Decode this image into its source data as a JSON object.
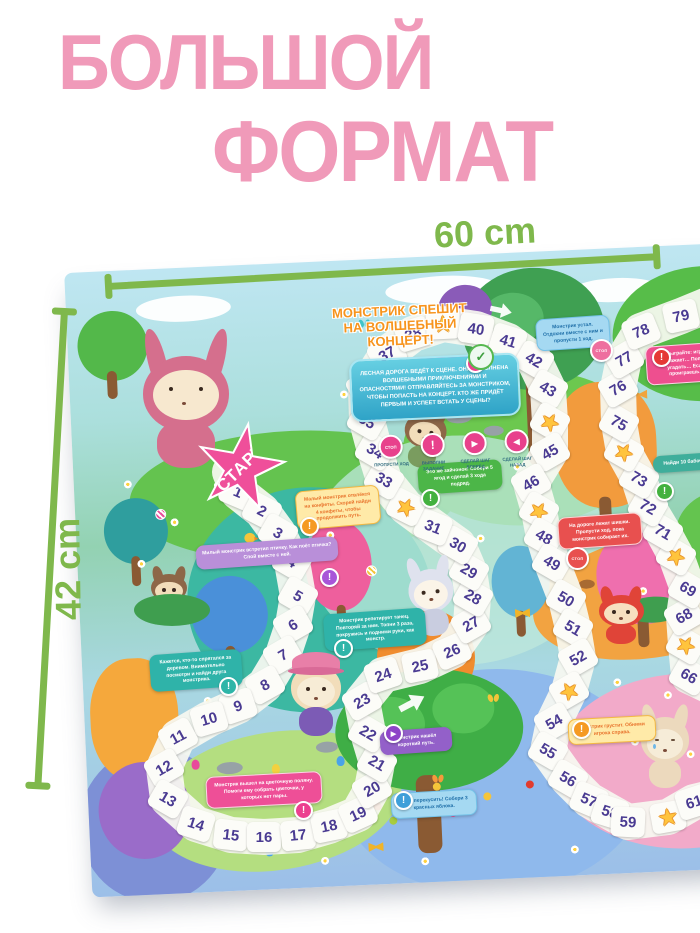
{
  "page": {
    "heading_line1": "БОЛЬШОЙ",
    "heading_line2": "ФОРМАТ",
    "width_label": "60 cm",
    "height_label": "42 cm",
    "colors": {
      "heading_pink": "#f09ab9",
      "measure_green": "#7fb84c",
      "cell_number": "#4a3b92",
      "start_pink": "#ef4f9a",
      "board_title_orange": "#f7941d"
    }
  },
  "icons": {
    "star": "★",
    "check": "✓",
    "task": "!",
    "fwd": "▶",
    "back": "◀"
  },
  "board": {
    "title_lines": [
      "МОНСТРИК СПЕШИТ",
      "НА ВОЛШЕБНЫЙ",
      "КОНЦЕРТ!"
    ],
    "intro_text": "ЛЕСНАЯ ДОРОГА ВЕДЁТ К СЦЕНЕ. ОНА НАПОЛНЕНА ВОЛШЕБНЫМИ ПРИКЛЮЧЕНИЯМИ И ОПАСНОСТЯМИ! ОТПРАВЛЯЙТЕСЬ ЗА МОНСТРИКОМ, ЧТОБЫ ПОПАСТЬ НА КОНЦЕРТ. КТО ЖЕ ПРИДЁТ ПЕРВЫМ И УСПЕЕТ ВСТАТЬ У СЦЕНЫ?",
    "start_label": "СТАРТ",
    "stop_chip": "СТОП",
    "legend": [
      {
        "icon": "stop",
        "label": "ПРОПУСТИ ХОД"
      },
      {
        "icon": "task",
        "label": "ВЫПОЛНИ ЗАДАНИЕ"
      },
      {
        "icon": "fwd",
        "label": "СДЕЛАЙ ШАГ ВПЕРЁД"
      },
      {
        "icon": "back",
        "label": "СДЕЛАЙ ШАГ НАЗАД"
      }
    ],
    "cells": [
      "1",
      "2",
      "3",
      "4",
      "5",
      "6",
      "7",
      "8",
      "9",
      "10",
      "11",
      "12",
      "13",
      "14",
      "15",
      "16",
      "17",
      "18",
      "19",
      "20",
      "21",
      "22",
      "23",
      "24",
      "25",
      "26",
      "27",
      "28",
      "29",
      "30",
      "31",
      "*",
      "33",
      "34",
      "35",
      "36",
      "37",
      "38",
      "*",
      "40",
      "41",
      "42",
      "43",
      "*",
      "45",
      "46",
      "*",
      "48",
      "49",
      "50",
      "51",
      "52",
      "*",
      "54",
      "55",
      "56",
      "57",
      "58",
      "59",
      "*",
      "61",
      "66",
      "*",
      "68",
      "69",
      "*",
      "71",
      "72",
      "73",
      "*",
      "75",
      "76",
      "77",
      "78",
      "79"
    ],
    "bubbles": [
      {
        "id": "bird",
        "color": "lavender",
        "icon": "task",
        "text": "Милый монстрик встретил птичку. Как поёт птичка? Спой вместе с ней."
      },
      {
        "id": "hidden-friend",
        "color": "teal",
        "icon": "task",
        "text": "Кажется, кто-то спрятался за деревом. Внимательно посмотри и найди друга монстрика."
      },
      {
        "id": "flower-meadow",
        "color": "pink",
        "icon": "task",
        "text": "Монстрик вышел на цветочную поляну. Помоги ему собрать цветочки, у которых нет пары."
      },
      {
        "id": "candies",
        "color": "cream",
        "icon": "task",
        "text": "Малый монстрик отвлёкся на конфеты. Скорей найди 4 конфеты, чтобы продолжить путь."
      },
      {
        "id": "dance",
        "color": "teal",
        "icon": "task",
        "text": "Монстрик репетирует танец. Повторяй за ним. Топни 3 раза, покружись и подними руки, как монстр."
      },
      {
        "id": "shortcut",
        "color": "violet",
        "icon": "fwd",
        "text": "Монстрик нашёл короткий путь."
      },
      {
        "id": "rabbit",
        "color": "green",
        "icon": "task",
        "text": "Это же зайчонок! Собери 5 ягод и сделай 3 хода подряд."
      },
      {
        "id": "friend-tracks",
        "color": "violet",
        "icon": "fwd",
        "text": "Монстрик увидел следы друзей. От радости он побежал вперёд! Пройди на 3 клетки вперёд."
      },
      {
        "id": "tired",
        "color": "sky",
        "icon": "stop",
        "text": "Монстрик устал. Отдохни вместе с ним и пропусти 1 ход."
      },
      {
        "id": "act-out",
        "color": "magenta",
        "icon": "task",
        "text": "Отыграйте: игрок изображает… Попробуй угадать… Если проиграешь…"
      },
      {
        "id": "butterflies",
        "color": "tealgreen",
        "icon": "task",
        "text": "Найди 10 бабочек…"
      },
      {
        "id": "pinecones",
        "color": "red",
        "icon": "stop",
        "text": "На дороге лежат шишки. Пропусти ход, пока монстрик собирает их."
      },
      {
        "id": "sad",
        "color": "cream",
        "icon": "task",
        "text": "Монстрик грустит. Обними игрока справа."
      },
      {
        "id": "apples",
        "color": "sky",
        "icon": "task",
        "text": "Пора перекусить! Собери 3 красных яблока."
      }
    ]
  }
}
